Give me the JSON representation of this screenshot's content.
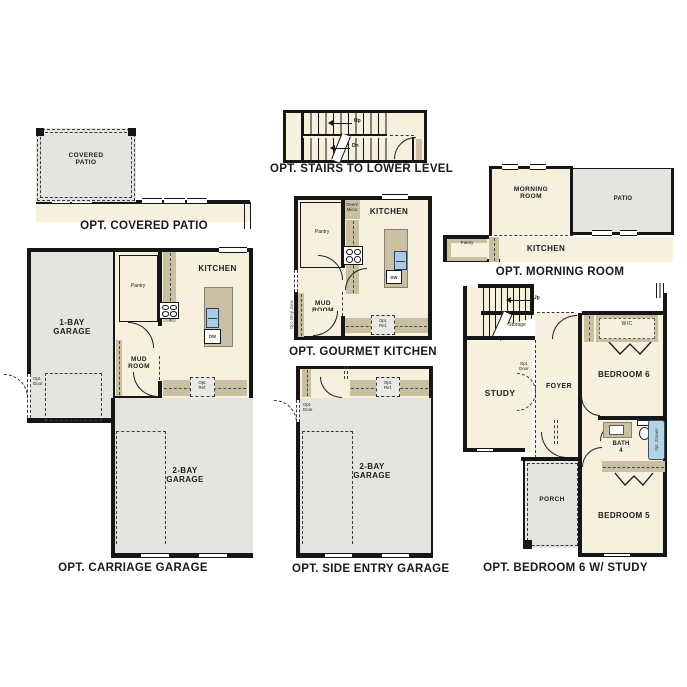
{
  "document": {
    "type": "floor-plan-options-sheet",
    "colors": {
      "floor": "#f7f0de",
      "hardscape_gray": "#e4e4e0",
      "counter_tan": "#cbbfa2",
      "wall_black": "#161616",
      "fixture_blue": "#aecade"
    }
  },
  "captions": {
    "covered_patio": "OPT. COVERED PATIO",
    "stairs_lower_level": "OPT. STAIRS TO LOWER LEVEL",
    "morning_room": "OPT. MORNING ROOM",
    "carriage_garage": "OPT. CARRIAGE GARAGE",
    "gourmet_kitchen": "OPT. GOURMET KITCHEN",
    "side_entry_garage": "OPT. SIDE ENTRY GARAGE",
    "bedroom6_study": "OPT. BEDROOM 6 W/ STUDY"
  },
  "labels": {
    "covered_patio": "COVERED\nPATIO",
    "up": "Up",
    "dn": "Dn",
    "morning_room": "MORNING\nROOM",
    "patio": "PATIO",
    "kitchen": "KITCHEN",
    "pantry": "Pantry",
    "one_bay_garage": "1-BAY\nGARAGE",
    "two_bay_garage": "2-BAY\nGARAGE",
    "mud_room": "MUD\nROOM",
    "opt_door": "Opt.\nDoor",
    "opt_ref": "Opt.\nRef.",
    "oven_micro": "Oven/\nMicro",
    "opt_drop_zone": "Opt. Drop Zone",
    "dw": "DW",
    "wh": "WH",
    "study": "STUDY",
    "foyer": "FOYER",
    "storage": "Storage",
    "bedroom_6": "BEDROOM 6",
    "bedroom_5": "BEDROOM 5",
    "wic": "WIC",
    "bath_4": "BATH\n4",
    "opt_shower": "Opt. Shower",
    "porch": "PORCH"
  }
}
